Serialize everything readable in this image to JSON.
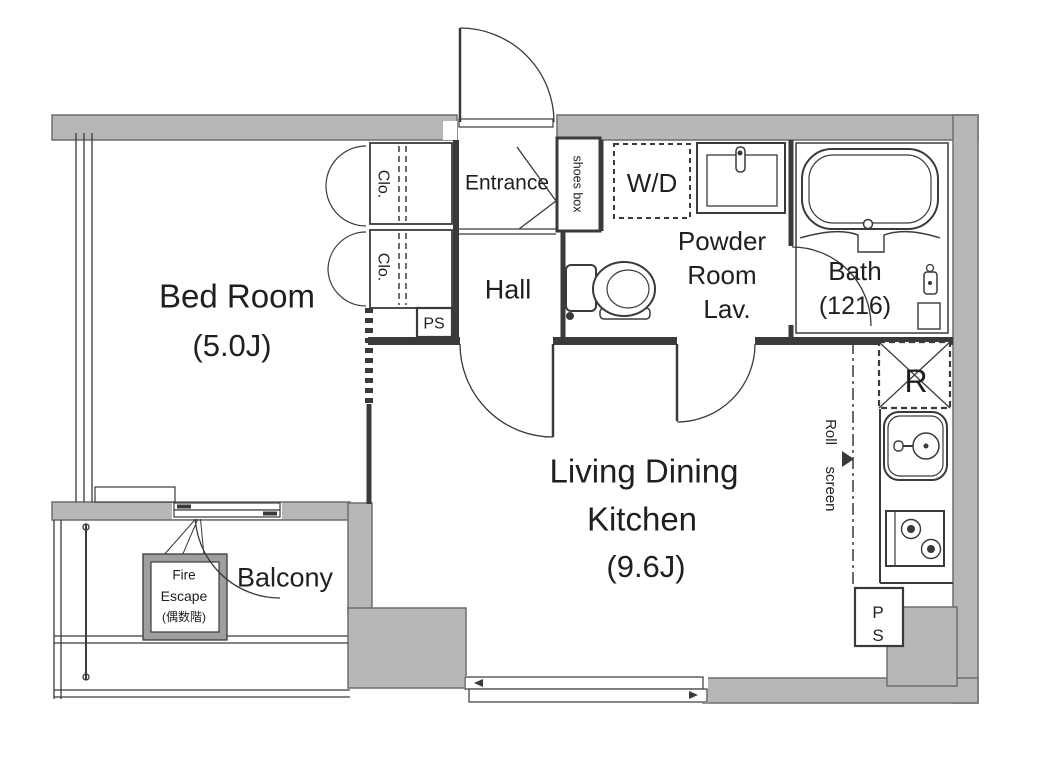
{
  "colors": {
    "wall_fill": "#b7b7b7",
    "wall_stroke": "#6e6e6e",
    "line": "#3a3a3a",
    "text_color": "#1f1f1f"
  },
  "rooms": {
    "bedroom": {
      "name": "Bed Room",
      "size": "(5.0J)"
    },
    "ldk": {
      "line1": "Living Dining",
      "line2": "Kitchen",
      "size": "(9.6J)"
    },
    "balcony": {
      "name": "Balcony"
    },
    "entrance": {
      "name": "Entrance"
    },
    "hall": {
      "name": "Hall"
    },
    "powder_room": {
      "line1": "Powder",
      "line2": "Room",
      "line3": "Lav."
    },
    "bath": {
      "name": "Bath",
      "size": "(1216)"
    },
    "wd": {
      "label": "W/D"
    },
    "closet1": {
      "label": "Clo."
    },
    "closet2": {
      "label": "Clo."
    },
    "shoes_box": {
      "label": "shoes box"
    },
    "refrigerator": {
      "label": "R"
    },
    "roll_screen": {
      "word1": "Roll",
      "word2": "screen"
    },
    "ps_hall": {
      "label": "PS"
    },
    "ps_kitchen": {
      "line1": "P",
      "line2": "S"
    },
    "fire_escape": {
      "line1": "Fire",
      "line2": "Escape",
      "line3": "(偶数階)"
    }
  }
}
